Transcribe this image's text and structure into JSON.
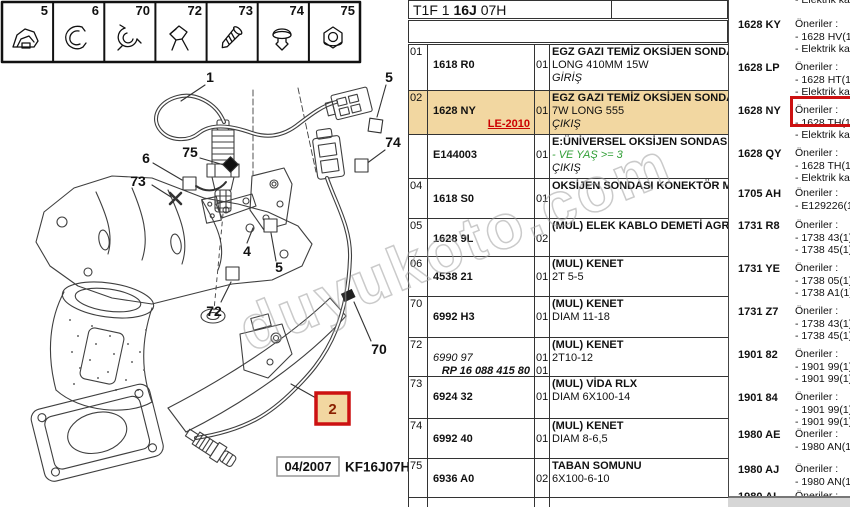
{
  "watermark": "duyukoto.com",
  "colors": {
    "highlight_row": "#f2d7a1",
    "highlight_border_red": "#cc1111",
    "link_red": "#cc0000",
    "condition_green": "#2f9e34"
  },
  "icon_strip": {
    "items": [
      {
        "num": "5",
        "icon": "retainer-clip"
      },
      {
        "num": "6",
        "icon": "spring-clip"
      },
      {
        "num": "70",
        "icon": "cable-clip"
      },
      {
        "num": "72",
        "icon": "wire-bracket"
      },
      {
        "num": "73",
        "icon": "screw"
      },
      {
        "num": "74",
        "icon": "push-rivet"
      },
      {
        "num": "75",
        "icon": "flange-nut"
      }
    ]
  },
  "diagram": {
    "callouts": {
      "c1": "1",
      "c5a": "5",
      "c74": "74",
      "c75": "75",
      "c6": "6",
      "c73": "73",
      "c4": "4",
      "c5b": "5",
      "c72": "72",
      "c70": "70",
      "c2": "2"
    },
    "highlighted_callout": "2",
    "date": "04/2007",
    "code": "KF16J07H"
  },
  "header": {
    "part1": "T1F 1",
    "part2": "16J",
    "part3": "07H"
  },
  "table": {
    "rows": [
      {
        "num": "01",
        "ref": "1618 R0",
        "qty": [
          "",
          "01"
        ],
        "desc": [
          [
            "b",
            "EGZ GAZI TEMİZ OKSİJEN SONDASI"
          ],
          [
            "n",
            "LONG 410MM 15W"
          ],
          [
            "i",
            "GİRİŞ"
          ]
        ]
      },
      {
        "num": "02",
        "ref": "1628 NY",
        "ref2": "LE-2010",
        "ref2Style": "r",
        "qty": [
          "",
          "01"
        ],
        "hl": true,
        "desc": [
          [
            "b",
            "EGZ GAZI TEMİZ OKSİJEN SONDASI"
          ],
          [
            "n",
            "7W LONG 555"
          ],
          [
            "i",
            "ÇIKIŞ"
          ]
        ]
      },
      {
        "num": "",
        "ref": "E144003",
        "qty": [
          "",
          "01"
        ],
        "desc": [
          [
            "b",
            "E:ÜNİVERSEL OKSİJEN SONDASI"
          ],
          [
            "gi",
            "- VE YAŞ >= 3"
          ],
          [
            "i",
            "ÇIKIŞ"
          ]
        ]
      },
      {
        "num": "04",
        "ref": "1618 S0",
        "qty": [
          "",
          "01"
        ],
        "desc": [
          [
            "b",
            "OKSİJEN SONDASI KONEKTÖR MESN"
          ]
        ]
      },
      {
        "num": "05",
        "ref": "1628 9L",
        "qty": [
          "",
          "02"
        ],
        "desc": [
          [
            "b",
            "(MUL) ELEK KABLO DEMETİ AGRAFI"
          ]
        ]
      },
      {
        "num": "06",
        "ref": "4538 21",
        "qty": [
          "",
          "01"
        ],
        "desc": [
          [
            "b",
            "(MUL) KENET"
          ],
          [
            "n",
            "2T 5-5"
          ]
        ]
      },
      {
        "num": "70",
        "ref": "6992 H3",
        "qty": [
          "",
          "01"
        ],
        "desc": [
          [
            "b",
            "(MUL) KENET"
          ],
          [
            "n",
            "DIAM 11-18"
          ]
        ]
      },
      {
        "num": "72",
        "ref": "6990 97",
        "refStyle": "i",
        "ref2": "RP 16 088 415 80",
        "ref2Style": "bi",
        "qty": [
          "",
          "01",
          "01"
        ],
        "desc": [
          [
            "b",
            "(MUL) KENET"
          ],
          [
            "n",
            "2T10-12"
          ]
        ]
      },
      {
        "num": "73",
        "ref": "6924 32",
        "qty": [
          "",
          "01"
        ],
        "desc": [
          [
            "b",
            "(MUL) VİDA RLX"
          ],
          [
            "n",
            "DIAM 6X100-14"
          ]
        ]
      },
      {
        "num": "74",
        "ref": "6992 40",
        "qty": [
          "",
          "01"
        ],
        "desc": [
          [
            "b",
            "(MUL) KENET"
          ],
          [
            "n",
            "DIAM 8-6,5"
          ]
        ]
      },
      {
        "num": "75",
        "ref": "6936 A0",
        "qty": [
          "",
          "02"
        ],
        "desc": [
          [
            "b",
            "TABAN SOMUNU"
          ],
          [
            "n",
            "6X100-6-10"
          ]
        ]
      }
    ]
  },
  "popup": {
    "partial_top": "- Elektrik kablo",
    "entries": [
      {
        "code": "1628 KY",
        "lines": [
          "Öneriler :",
          "- 1628 HV(1)",
          "- Elektrik kablo"
        ]
      },
      {
        "code": "1628 LP",
        "lines": [
          "Öneriler :",
          "- 1628 HT(1)",
          "- Elektrik kablo"
        ]
      },
      {
        "code": "1628 NY",
        "lines": [
          "Öneriler :",
          "- 1628 TH(1)",
          "- Elektrik kablo"
        ],
        "highlight": true
      },
      {
        "code": "1628 QY",
        "lines": [
          "Öneriler :",
          "- 1628 TH(1)",
          "- Elektrik kablo"
        ]
      },
      {
        "code": "1705 AH",
        "lines": [
          "Öneriler :",
          "- E129226(1)"
        ]
      },
      {
        "code": "1731 R8",
        "lines": [
          "Öneriler :",
          "- 1738 43(1) +",
          "- 1738 45(1) +"
        ]
      },
      {
        "code": "1731 YE",
        "lines": [
          "Öneriler :",
          "- 1738 05(1) K",
          "- 1738 A1(1) O"
        ]
      },
      {
        "code": "1731 Z7",
        "lines": [
          "Öneriler :",
          "- 1738 43(1) +",
          "- 1738 45(1) +"
        ]
      },
      {
        "code": "1901 82",
        "lines": [
          "Öneriler :",
          "- 1901 99(1) +",
          "- 1901 99(1) O"
        ]
      },
      {
        "code": "1901 84",
        "lines": [
          "Öneriler :",
          "- 1901 99(1) +",
          "- 1901 99(1) O"
        ]
      },
      {
        "code": "1980 AE",
        "lines": [
          "Öneriler :",
          "- 1980 AN(1) 2"
        ]
      },
      {
        "code": "1980 AJ",
        "lines": [
          "Öneriler :",
          "- 1980 AN(1) 2"
        ]
      },
      {
        "code": "1980 AL",
        "lines": [
          "Öneriler :"
        ],
        "partial": true
      }
    ]
  }
}
